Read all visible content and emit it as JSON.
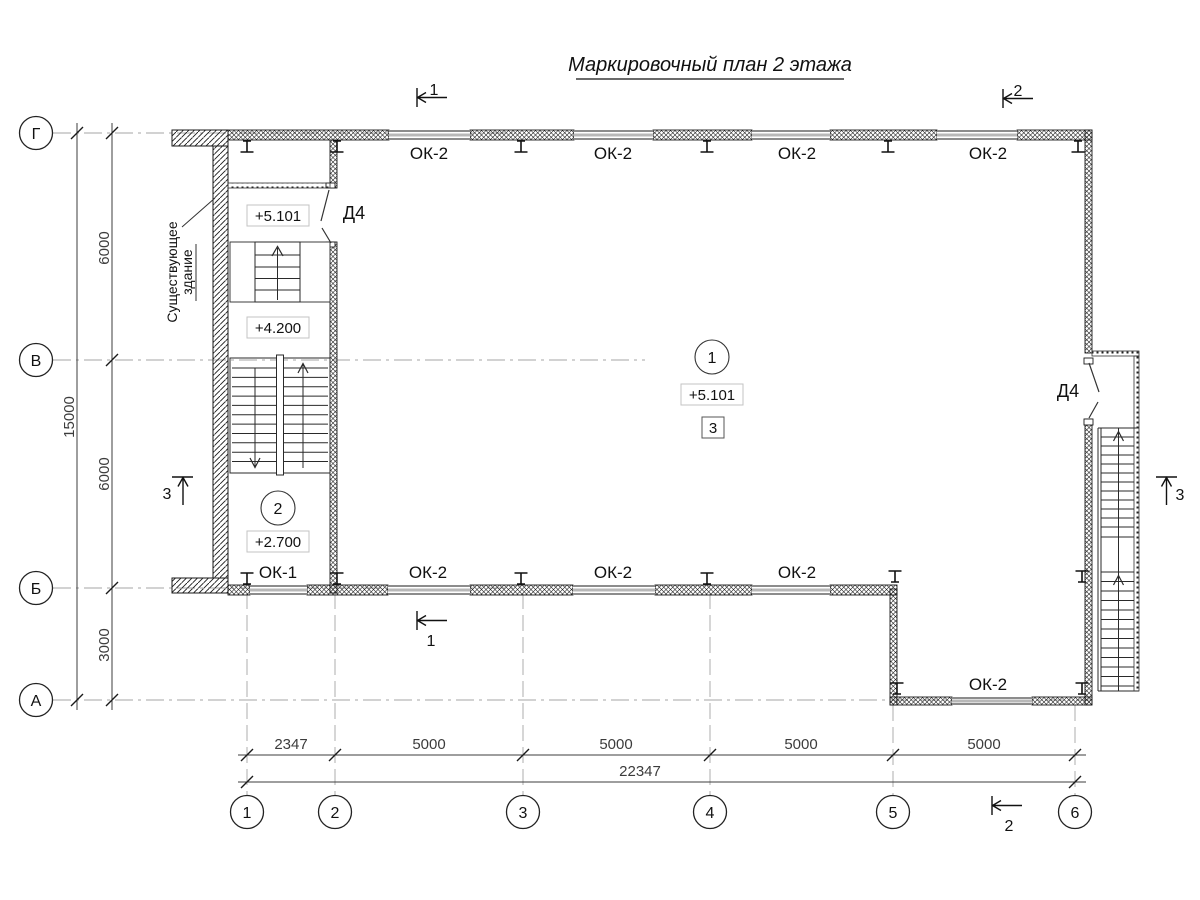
{
  "title": {
    "text": "Маркировочный план 2 этажа"
  },
  "axes": {
    "rows": [
      {
        "label": "Г"
      },
      {
        "label": "В"
      },
      {
        "label": "Б"
      },
      {
        "label": "А"
      }
    ],
    "cols": [
      {
        "label": "1"
      },
      {
        "label": "2"
      },
      {
        "label": "3"
      },
      {
        "label": "4"
      },
      {
        "label": "5"
      },
      {
        "label": "6"
      }
    ]
  },
  "dimensions": {
    "vertical": {
      "spans": [
        "6000",
        "6000",
        "3000"
      ],
      "total": "15000"
    },
    "horizontal": {
      "spans": [
        "2347",
        "5000",
        "5000",
        "5000"
      ],
      "span5": "5000",
      "total": "22347"
    }
  },
  "windows": {
    "top": [
      "ОК-2",
      "ОК-2",
      "ОК-2",
      "ОК-2"
    ],
    "bottom": [
      "ОК-1",
      "ОК-2",
      "ОК-2",
      "ОК-2"
    ],
    "extension": "ОК-2"
  },
  "doors": {
    "left": "Д4",
    "right": "Д4"
  },
  "levels": {
    "stair_upper": "+5.101",
    "stair_mid": "+4.200",
    "room2": "+2.700",
    "hall": "+5.101"
  },
  "rooms": {
    "hall_number": "1",
    "stair_number": "2",
    "hall_detail": "3"
  },
  "sections": {
    "s1": "1",
    "s2": "2",
    "s3": "3"
  },
  "annotations": {
    "existing_line1": "Существующее",
    "existing_line2": "здание"
  },
  "colors": {
    "line": "#1a1a1a",
    "dim": "#3c3c3c",
    "axis": "#a6a6a6",
    "glass": "#b8b8b8",
    "box_border": "#c3c3c3"
  }
}
